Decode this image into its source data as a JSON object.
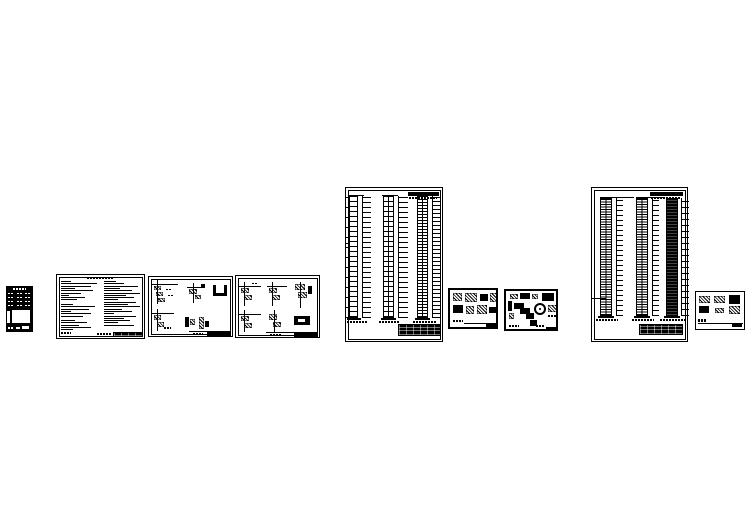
{
  "page": {
    "background": "#ffffff",
    "ink": "#000000",
    "description": "preview of nine CAD structural drawing sheet thumbnails"
  },
  "sheets": [
    {
      "kind": "dark schedule/table mini sheet",
      "x": 6,
      "y": 286,
      "w": 27,
      "h": 46,
      "theme": "dark",
      "border": 0,
      "blobs": [
        [
          7,
          2,
          13,
          2,
          "smudge",
          "w"
        ],
        [
          2,
          7,
          6,
          1.3,
          "smudge",
          "w"
        ],
        [
          11,
          7,
          6,
          1.3,
          "smudge",
          "w"
        ],
        [
          19,
          7,
          6,
          1.3,
          "smudge",
          "w"
        ],
        [
          2,
          11,
          6,
          1.3,
          "smudge",
          "w"
        ],
        [
          11,
          11,
          6,
          1.3,
          "smudge",
          "w"
        ],
        [
          19,
          11,
          6,
          1.3,
          "smudge",
          "w"
        ],
        [
          2,
          15,
          6,
          1.3,
          "smudge",
          "w"
        ],
        [
          11,
          15,
          6,
          1.3,
          "smudge",
          "w"
        ],
        [
          19,
          15,
          6,
          1.3,
          "smudge",
          "w"
        ],
        [
          2,
          19,
          6,
          1.3,
          "smudge",
          "w"
        ],
        [
          11,
          19,
          6,
          1.3,
          "smudge",
          "w"
        ],
        [
          19,
          19,
          6,
          1.3,
          "smudge",
          "w"
        ],
        [
          6,
          24,
          18,
          13,
          "solid",
          "w"
        ],
        [
          1,
          25,
          3,
          12,
          "solid",
          "w"
        ],
        [
          2,
          41,
          6,
          1.5,
          "smudge",
          "w"
        ],
        [
          10,
          41,
          4,
          1.5,
          "solid",
          "w"
        ],
        [
          16,
          40,
          7,
          2.5,
          "solid",
          "w"
        ]
      ]
    },
    {
      "kind": "general notes sheet with two text columns",
      "x": 56,
      "y": 274,
      "w": 89,
      "h": 65,
      "theme": "light",
      "border": 1.5,
      "frame": true,
      "notes": {
        "left": {
          "x": 4,
          "y": 6,
          "pitch": 2.3,
          "lines": [
            10,
            36,
            30,
            14,
            32,
            20,
            8,
            24,
            16,
            0,
            12,
            34,
            28,
            10,
            30,
            22,
            0,
            14,
            26,
            18,
            30,
            12
          ]
        },
        "right": {
          "x": 47,
          "y": 6,
          "pitch": 2.3,
          "lines": [
            12,
            20,
            34,
            16,
            28,
            36,
            22,
            30,
            14,
            32,
            24,
            36,
            18,
            28,
            10,
            32,
            20,
            26,
            14,
            30
          ]
        }
      },
      "blobs": [
        [
          30,
          2,
          26,
          2,
          "smudge"
        ],
        [
          4,
          57,
          10,
          1.5,
          "smudge"
        ],
        [
          40,
          58,
          14,
          1.5,
          "smudge"
        ],
        [
          56,
          57,
          30,
          5,
          "tb"
        ]
      ]
    },
    {
      "kind": "stair structural details sheet 1",
      "x": 148,
      "y": 276,
      "w": 85,
      "h": 61,
      "theme": "light",
      "border": 1.5,
      "frame": true,
      "blobs": [
        [
          3,
          7,
          26,
          0.7,
          "line"
        ],
        [
          8,
          3,
          0.7,
          24,
          "line"
        ],
        [
          5,
          9,
          7,
          4,
          "hatch"
        ],
        [
          7,
          15,
          7,
          4,
          "hatch"
        ],
        [
          9,
          21,
          7,
          4,
          "hatch"
        ],
        [
          17,
          12,
          6,
          1,
          "smudge"
        ],
        [
          19,
          18,
          6,
          1,
          "smudge"
        ],
        [
          38,
          10,
          18,
          0.7,
          "line"
        ],
        [
          44,
          6,
          0.7,
          20,
          "line"
        ],
        [
          40,
          12,
          8,
          5,
          "hatch"
        ],
        [
          46,
          18,
          6,
          4,
          "hatch"
        ],
        [
          52,
          7,
          4,
          3,
          "solid"
        ],
        [
          64,
          8,
          3,
          11,
          "solid"
        ],
        [
          75,
          8,
          3,
          11,
          "solid"
        ],
        [
          64,
          16,
          14,
          3,
          "solid"
        ],
        [
          3,
          36,
          22,
          0.7,
          "line"
        ],
        [
          8,
          32,
          0.7,
          22,
          "line"
        ],
        [
          5,
          38,
          7,
          5,
          "hatch"
        ],
        [
          8,
          45,
          7,
          5,
          "hatch"
        ],
        [
          15,
          50,
          7,
          1.5,
          "smudge"
        ],
        [
          36,
          40,
          4,
          10,
          "solid"
        ],
        [
          41,
          42,
          5,
          6,
          "hatch"
        ],
        [
          50,
          40,
          5,
          12,
          "hatch"
        ],
        [
          56,
          44,
          4,
          6,
          "solid"
        ],
        [
          40,
          54,
          42,
          0.6,
          "line"
        ],
        [
          58,
          55,
          24,
          4,
          "solid"
        ],
        [
          44,
          56,
          10,
          1.5,
          "smudge"
        ]
      ]
    },
    {
      "kind": "stair structural details sheet 2",
      "x": 235,
      "y": 275,
      "w": 85,
      "h": 63,
      "theme": "light",
      "border": 1.5,
      "frame": true,
      "blobs": [
        [
          3,
          10,
          22,
          0.7,
          "line"
        ],
        [
          8,
          6,
          0.7,
          24,
          "line"
        ],
        [
          5,
          12,
          8,
          5,
          "hatch"
        ],
        [
          8,
          19,
          8,
          5,
          "hatch"
        ],
        [
          16,
          7,
          6,
          1,
          "smudge"
        ],
        [
          31,
          10,
          20,
          0.7,
          "line"
        ],
        [
          36,
          6,
          0.7,
          24,
          "line"
        ],
        [
          33,
          12,
          8,
          5,
          "hatch"
        ],
        [
          36,
          19,
          8,
          5,
          "hatch"
        ],
        [
          64,
          6,
          0.7,
          26,
          "line"
        ],
        [
          59,
          8,
          10,
          6,
          "hatch"
        ],
        [
          62,
          16,
          9,
          6,
          "hatch"
        ],
        [
          72,
          10,
          4,
          8,
          "solid"
        ],
        [
          3,
          38,
          22,
          0.7,
          "line"
        ],
        [
          8,
          34,
          0.7,
          22,
          "line"
        ],
        [
          5,
          40,
          8,
          5,
          "hatch"
        ],
        [
          8,
          47,
          8,
          5,
          "hatch"
        ],
        [
          38,
          34,
          0.7,
          22,
          "line"
        ],
        [
          33,
          38,
          8,
          6,
          "hatch"
        ],
        [
          37,
          46,
          8,
          5,
          "hatch"
        ],
        [
          58,
          40,
          16,
          9,
          "solid"
        ],
        [
          62,
          43,
          7,
          3,
          "solid",
          "w"
        ],
        [
          30,
          56,
          52,
          0.6,
          "line"
        ],
        [
          58,
          57,
          24,
          4,
          "solid"
        ],
        [
          34,
          58,
          12,
          1.5,
          "smudge"
        ]
      ]
    },
    {
      "kind": "column/wall elevation schedule sheet 1 with three tower diagrams",
      "x": 345,
      "y": 187,
      "w": 98,
      "h": 155,
      "theme": "light",
      "border": 1.5,
      "frame": true,
      "towers": [
        {
          "x": 3,
          "y": 8,
          "w": 9,
          "h": 122,
          "pitch": 5,
          "center": false,
          "tick": {
            "x": 16,
            "w": 8,
            "pitch": 5
          },
          "ltick": {
            "x": 0,
            "w": 3,
            "pitch": 10
          }
        },
        {
          "x": 37,
          "y": 8,
          "w": 11,
          "h": 122,
          "pitch": 5,
          "center": true,
          "tick": {
            "x": 52,
            "w": 9,
            "pitch": 5
          }
        },
        {
          "x": 71,
          "y": 8,
          "w": 11,
          "h": 122,
          "pitch": 3,
          "center": true,
          "tick": {
            "x": 86,
            "w": 8,
            "pitch": 4
          }
        }
      ],
      "blobs": [
        [
          62,
          4,
          31,
          4,
          "solid"
        ],
        [
          63,
          9,
          28,
          1.5,
          "smudge"
        ],
        [
          2,
          7,
          16,
          0.8,
          "line"
        ],
        [
          36,
          7,
          16,
          0.8,
          "line"
        ],
        [
          70,
          7,
          16,
          0.8,
          "line"
        ],
        [
          0,
          55,
          3,
          1,
          "solid"
        ],
        [
          0,
          59,
          3,
          1,
          "solid"
        ],
        [
          1,
          130,
          14,
          2,
          "solid"
        ],
        [
          35,
          130,
          15,
          2,
          "solid"
        ],
        [
          69,
          130,
          15,
          2,
          "solid"
        ],
        [
          1,
          133,
          20,
          2,
          "smudge"
        ],
        [
          33,
          133,
          21,
          2,
          "smudge"
        ],
        [
          67,
          133,
          23,
          2,
          "smudge"
        ],
        [
          52,
          136,
          43,
          12,
          "tb"
        ]
      ]
    },
    {
      "kind": "connection details sheet A",
      "x": 448,
      "y": 288,
      "w": 50,
      "h": 41,
      "theme": "light",
      "border": 2,
      "blobs": [
        [
          3,
          3,
          9,
          8,
          "hatch"
        ],
        [
          15,
          3,
          12,
          9,
          "hatch"
        ],
        [
          30,
          4,
          8,
          7,
          "solid"
        ],
        [
          40,
          3,
          7,
          9,
          "hatch"
        ],
        [
          3,
          15,
          10,
          8,
          "solid"
        ],
        [
          16,
          16,
          8,
          8,
          "hatch"
        ],
        [
          27,
          15,
          10,
          9,
          "hatch"
        ],
        [
          39,
          17,
          8,
          6,
          "solid"
        ],
        [
          3,
          30,
          10,
          2,
          "smudge"
        ],
        [
          14,
          33,
          33,
          0.6,
          "line"
        ],
        [
          36,
          34,
          11,
          3.5,
          "solid"
        ]
      ]
    },
    {
      "kind": "connection details sheet B with circular detail",
      "x": 504,
      "y": 289,
      "w": 54,
      "h": 42,
      "theme": "light",
      "border": 2,
      "blobs": [
        [
          4,
          3,
          8,
          5,
          "hatch"
        ],
        [
          14,
          2,
          10,
          6,
          "solid"
        ],
        [
          26,
          3,
          6,
          5,
          "hatch"
        ],
        [
          36,
          2,
          12,
          8,
          "solid"
        ],
        [
          2,
          10,
          4,
          10,
          "solid"
        ],
        [
          3,
          22,
          5,
          6,
          "hatch"
        ],
        [
          8,
          12,
          10,
          6,
          "solid"
        ],
        [
          14,
          17,
          10,
          6,
          "solid"
        ],
        [
          20,
          22,
          8,
          6,
          "solid"
        ],
        [
          28,
          12,
          12,
          12,
          "ring"
        ],
        [
          42,
          14,
          9,
          7,
          "hatch"
        ],
        [
          42,
          24,
          8,
          2,
          "smudge"
        ],
        [
          24,
          29,
          7,
          6,
          "solid"
        ],
        [
          3,
          34,
          10,
          2,
          "smudge"
        ],
        [
          30,
          34,
          8,
          1.5,
          "smudge"
        ],
        [
          40,
          36,
          11,
          3.5,
          "solid"
        ]
      ]
    },
    {
      "kind": "column/wall elevation schedule sheet 2 with three dense tower diagrams",
      "x": 591,
      "y": 187,
      "w": 97,
      "h": 155,
      "theme": "light",
      "border": 1.5,
      "frame": true,
      "towers": [
        {
          "x": 8,
          "y": 10,
          "w": 12,
          "h": 118,
          "pitch": 2.5,
          "center": true,
          "tick": {
            "x": 24,
            "w": 6,
            "pitch": 5
          }
        },
        {
          "x": 44,
          "y": 10,
          "w": 12,
          "h": 118,
          "pitch": 2.5,
          "center": true,
          "tick": {
            "x": 60,
            "w": 6,
            "pitch": 5
          }
        },
        {
          "x": 74,
          "y": 10,
          "w": 12,
          "h": 118,
          "fill": true,
          "tick": {
            "x": 89,
            "w": 7,
            "pitch": 6
          }
        }
      ],
      "blobs": [
        [
          58,
          4,
          33,
          4,
          "solid"
        ],
        [
          59,
          9,
          30,
          1.5,
          "smudge"
        ],
        [
          8,
          9,
          34,
          0.8,
          "line"
        ],
        [
          44,
          9,
          28,
          0.8,
          "line"
        ],
        [
          0,
          110,
          14,
          1.2,
          "solid"
        ],
        [
          6,
          128,
          16,
          2,
          "solid"
        ],
        [
          42,
          128,
          16,
          2,
          "solid"
        ],
        [
          72,
          128,
          16,
          2,
          "solid"
        ],
        [
          4,
          131,
          22,
          2.2,
          "smudge"
        ],
        [
          40,
          131,
          22,
          2.2,
          "smudge"
        ],
        [
          68,
          131,
          25,
          2.2,
          "smudge"
        ],
        [
          47,
          136,
          44,
          11,
          "tb"
        ]
      ]
    },
    {
      "kind": "foundation details mini sheet",
      "x": 695,
      "y": 291,
      "w": 50,
      "h": 39,
      "theme": "light",
      "border": 1.5,
      "blobs": [
        [
          3,
          4,
          11,
          7,
          "hatch"
        ],
        [
          18,
          4,
          11,
          7,
          "hatch"
        ],
        [
          33,
          3,
          11,
          9,
          "solid"
        ],
        [
          3,
          14,
          10,
          7,
          "solid"
        ],
        [
          19,
          16,
          9,
          5,
          "hatch"
        ],
        [
          33,
          14,
          11,
          8,
          "hatch"
        ],
        [
          2,
          27,
          8,
          3,
          "smudge"
        ],
        [
          2,
          31,
          45,
          0.6,
          "line"
        ],
        [
          36,
          32,
          10,
          3,
          "solid"
        ]
      ]
    }
  ]
}
